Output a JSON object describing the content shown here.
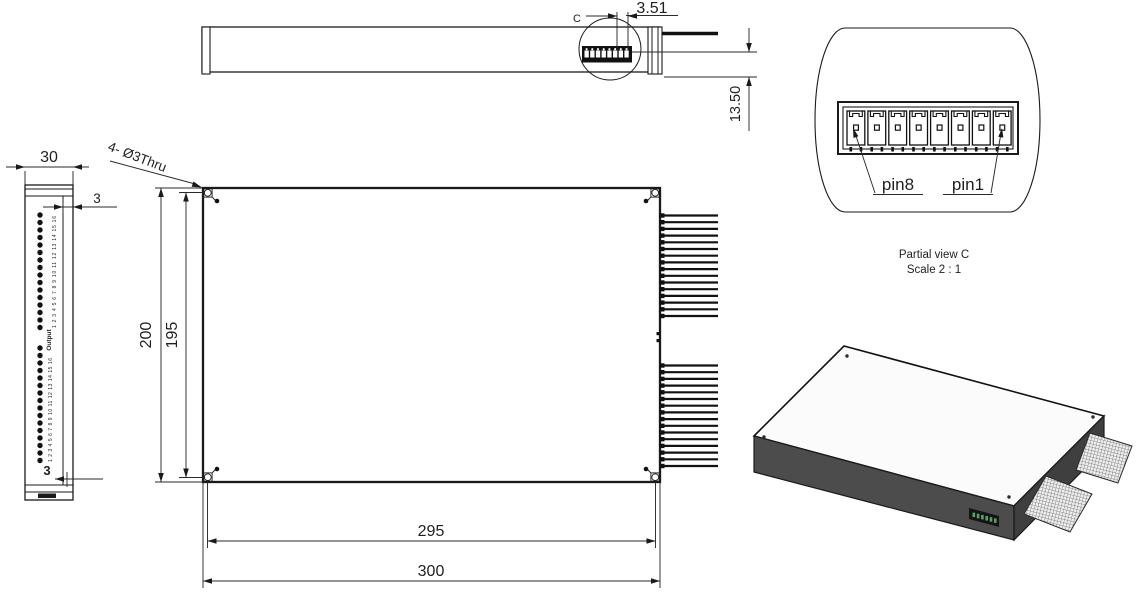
{
  "drawing": {
    "top_view": {
      "detail_marker": "C",
      "dim_connector_offset": "3.51",
      "dim_connector_to_base": "13.50"
    },
    "side_view": {
      "dim_depth": "30",
      "dim_panel": "3",
      "dim_bottom": "3",
      "port_labels_top": "1 2 3 4 5 6 7 8 9 10 11 12 13 14 15 16",
      "port_labels_bottom": "1 2 3 4 5 6 7 8 9 10 11 12 13 14 15 16",
      "group_label": "Output"
    },
    "front_view": {
      "hole_callout": "4- Ø3Thru",
      "dim_height_outer": "200",
      "dim_height_holes": "195",
      "dim_width_holes": "295",
      "dim_width_outer": "300"
    },
    "partial_view_c": {
      "label_pin8": "pin8",
      "label_pin1": "pin1",
      "caption": "Partial view C",
      "scale": "Scale 2 : 1"
    },
    "colors": {
      "dim_highlight": "#2e53c9",
      "line": "#1a1a1a",
      "face_front": "#4c4c4c",
      "face_side": "#3f3f3f",
      "face_top": "#fbfbfb"
    }
  }
}
